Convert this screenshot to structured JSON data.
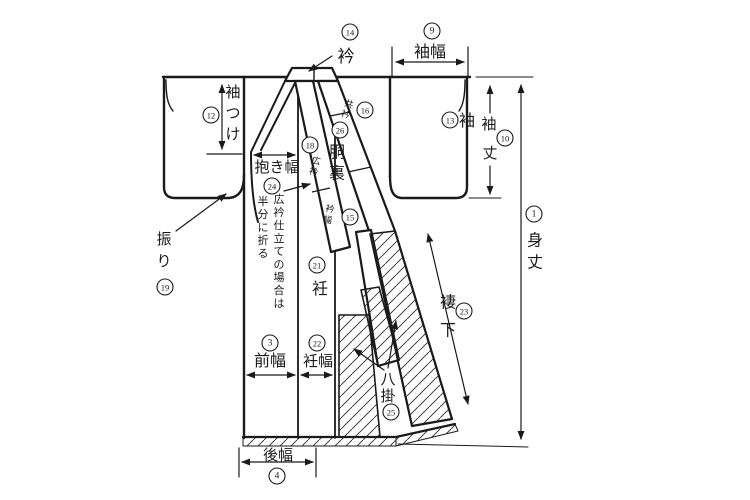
{
  "colors": {
    "line": "#1a1a1a",
    "background": "#ffffff"
  },
  "labels": [
    {
      "id": "eri",
      "text": "衿",
      "x": 346,
      "y": 62,
      "size": 17,
      "mode": "h"
    },
    {
      "id": "sodehaba",
      "text": "袖幅",
      "x": 430,
      "y": 57,
      "size": 16,
      "mode": "h"
    },
    {
      "id": "sode",
      "text": "袖",
      "x": 467,
      "y": 126,
      "size": 16,
      "mode": "h"
    },
    {
      "id": "sodetsuke",
      "text": "袖つけ",
      "x": 233,
      "y": 93,
      "size": 15,
      "mode": "v",
      "step": 21
    },
    {
      "id": "dakihaba",
      "text": "抱き幅",
      "x": 277,
      "y": 172,
      "size": 15,
      "mode": "h"
    },
    {
      "id": "hiroeri-note-1",
      "text": "広衿仕立ての場合は",
      "x": 279,
      "y": 200,
      "size": 11,
      "mode": "v",
      "step": 13
    },
    {
      "id": "hiroeri-note-2",
      "text": "半分に折る",
      "x": 263,
      "y": 202,
      "size": 11,
      "mode": "v",
      "step": 13
    },
    {
      "id": "furi",
      "text": "振り",
      "x": 164,
      "y": 240,
      "size": 15,
      "mode": "v",
      "step": 22
    },
    {
      "id": "okumi",
      "text": "衽",
      "x": 320,
      "y": 294,
      "size": 16,
      "mode": "h"
    },
    {
      "id": "maehaba",
      "text": "前幅",
      "x": 270,
      "y": 366,
      "size": 16,
      "mode": "h"
    },
    {
      "id": "okumihaba",
      "text": "衽幅",
      "x": 318,
      "y": 366,
      "size": 15,
      "mode": "h"
    },
    {
      "id": "ushirohaba",
      "text": "後幅",
      "x": 278,
      "y": 460,
      "size": 15,
      "mode": "h"
    },
    {
      "id": "hakkake",
      "text": "八掛",
      "x": 388,
      "y": 380,
      "size": 15,
      "mode": "v",
      "step": 17
    },
    {
      "id": "tsumashita",
      "text": "褄下",
      "x": 448,
      "y": 303,
      "size": 16,
      "mode": "v",
      "step": 28
    },
    {
      "id": "douura",
      "text": "胴裏",
      "x": 337,
      "y": 153,
      "size": 16,
      "mode": "v",
      "step": 21
    },
    {
      "id": "mitake",
      "text": "身丈",
      "x": 535,
      "y": 241,
      "size": 16,
      "mode": "v",
      "step": 22
    },
    {
      "id": "sodetake-sode",
      "text": "袖",
      "x": 489,
      "y": 129,
      "size": 15,
      "mode": "h"
    },
    {
      "id": "sodetake-take",
      "text": "丈",
      "x": 490,
      "y": 158,
      "size": 15,
      "mode": "h"
    },
    {
      "id": "tomoeri",
      "text": "共衿",
      "x": 349,
      "y": 104,
      "size": 9,
      "mode": "v",
      "step": 11,
      "rotate": 18
    },
    {
      "id": "hirokoeri",
      "text": "広衿",
      "x": 316,
      "y": 161,
      "size": 9,
      "mode": "v",
      "step": 11,
      "rotate": 12
    },
    {
      "id": "erihaba",
      "text": "衿幅",
      "x": 330,
      "y": 209,
      "size": 9,
      "mode": "v",
      "step": 11,
      "rotate": 12
    }
  ],
  "circled_numbers": [
    {
      "id": "c1",
      "n": "1",
      "x": 534,
      "y": 214
    },
    {
      "id": "c3",
      "n": "3",
      "x": 270,
      "y": 343
    },
    {
      "id": "c4",
      "n": "4",
      "x": 277,
      "y": 476
    },
    {
      "id": "c9",
      "n": "9",
      "x": 432,
      "y": 31
    },
    {
      "id": "c10",
      "n": "10",
      "x": 505,
      "y": 138
    },
    {
      "id": "c12",
      "n": "12",
      "x": 211,
      "y": 115
    },
    {
      "id": "c13",
      "n": "13",
      "x": 450,
      "y": 120
    },
    {
      "id": "c14",
      "n": "14",
      "x": 350,
      "y": 32
    },
    {
      "id": "c15",
      "n": "15",
      "x": 350,
      "y": 217
    },
    {
      "id": "c16",
      "n": "16",
      "x": 365,
      "y": 110
    },
    {
      "id": "c18",
      "n": "18",
      "x": 310,
      "y": 145
    },
    {
      "id": "c19",
      "n": "19",
      "x": 165,
      "y": 287
    },
    {
      "id": "c21",
      "n": "21",
      "x": 317,
      "y": 265
    },
    {
      "id": "c22",
      "n": "22",
      "x": 317,
      "y": 343
    },
    {
      "id": "c23",
      "n": "23",
      "x": 464,
      "y": 311
    },
    {
      "id": "c24",
      "n": "24",
      "x": 272,
      "y": 186
    },
    {
      "id": "c25",
      "n": "25",
      "x": 391,
      "y": 412
    },
    {
      "id": "c26",
      "n": "26",
      "x": 340,
      "y": 130
    }
  ]
}
